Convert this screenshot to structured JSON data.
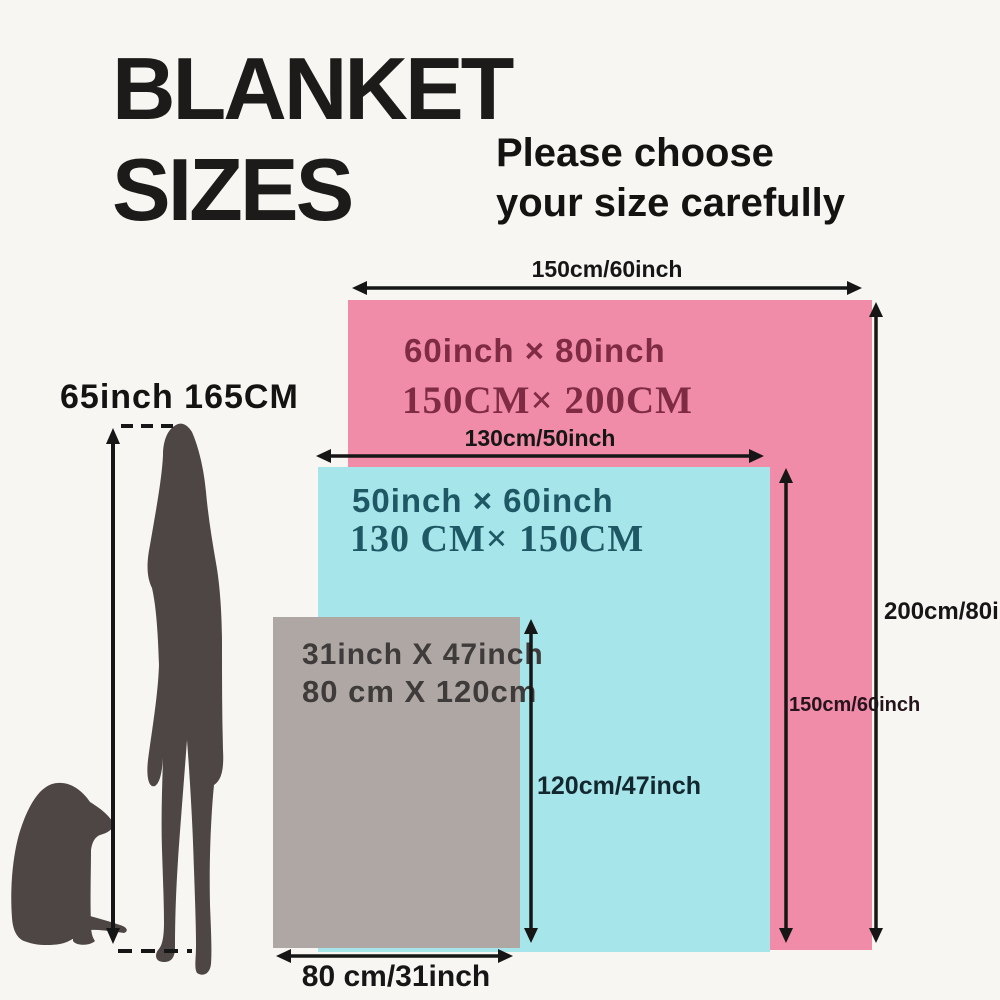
{
  "title": {
    "line1": "BLANKET",
    "line2": "SIZES"
  },
  "subtitle": {
    "line1": "Please choose",
    "line2": "your size carefully"
  },
  "person": {
    "height_label": "65inch 165CM"
  },
  "blankets": {
    "large": {
      "size_inch": "60inch × 80inch",
      "size_cm": "150CM× 200CM",
      "width_label": "150cm/60inch",
      "height_label": "200cm/80inch",
      "fill": "#f08ba8",
      "text_color": "#7e2b43"
    },
    "medium": {
      "size_inch": "50inch × 60inch",
      "size_cm": "130 CM× 150CM",
      "width_label": "130cm/50inch",
      "height_label": "150cm/60inch",
      "fill": "#a6e5ea",
      "text_color": "#1e5864"
    },
    "small": {
      "size_inch": "31inch X 47inch",
      "size_cm": "80 cm X 120cm",
      "width_label": "80 cm/31inch",
      "height_label": "120cm/47inch",
      "fill": "#aea7a4",
      "text_color": "#3e3b3a"
    }
  },
  "colors": {
    "background": "#f8f6f2",
    "arrow": "#161616",
    "silhouette": "#4d4644"
  }
}
